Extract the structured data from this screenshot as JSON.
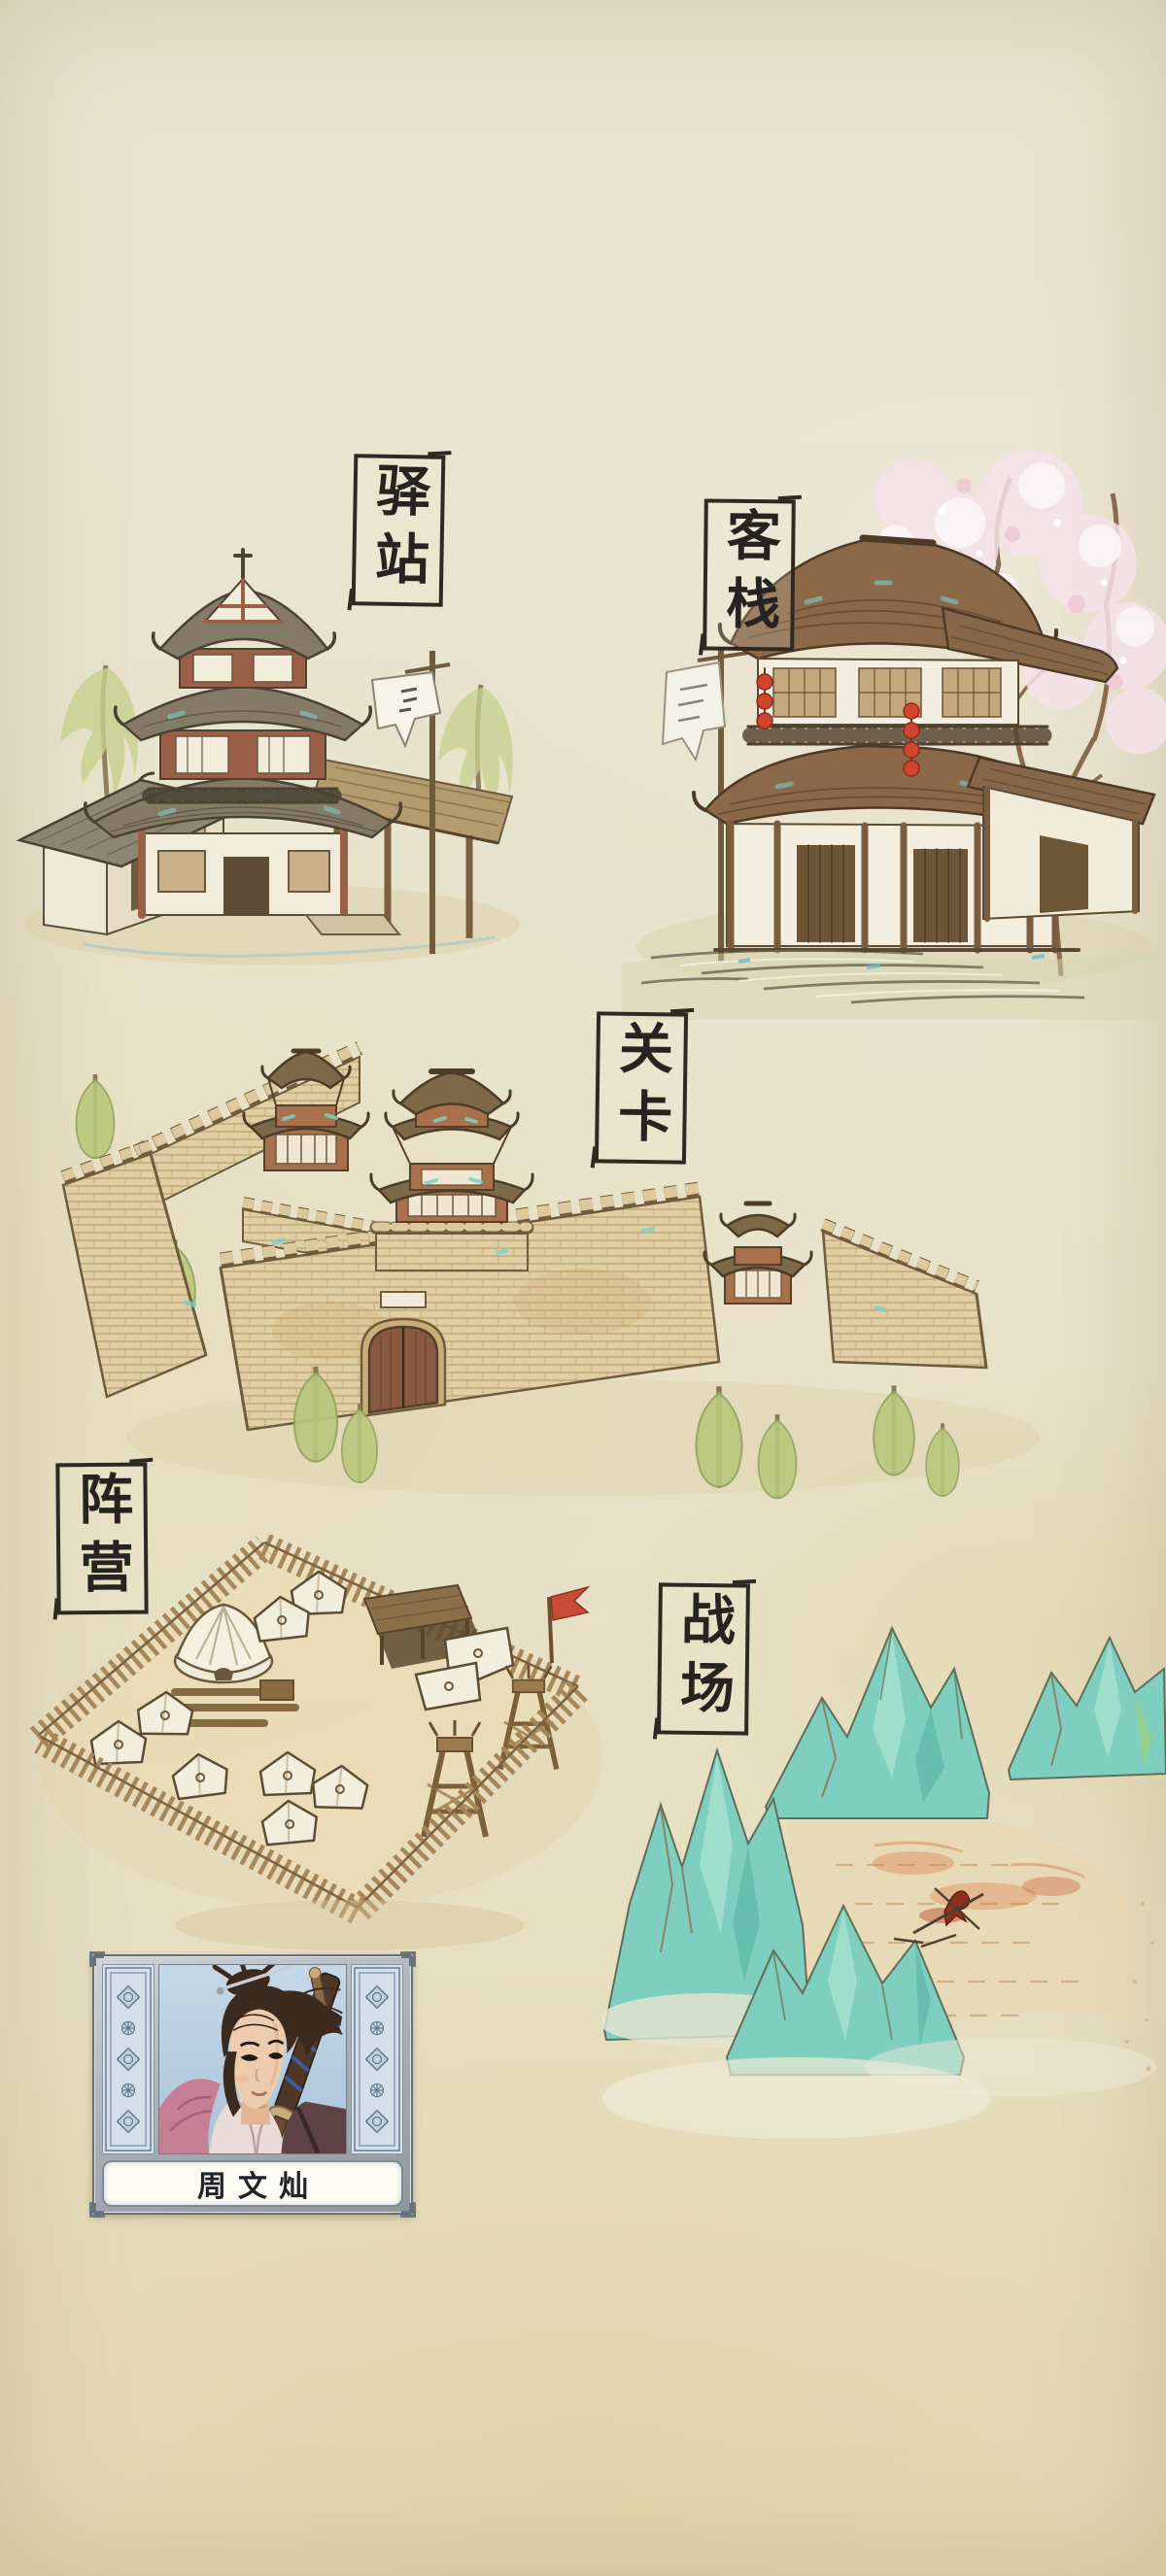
{
  "map": {
    "name": "hand-painted watercolor world map",
    "locations": [
      {
        "id": "post-station",
        "label": "驿站"
      },
      {
        "id": "inn",
        "label": "客栈"
      },
      {
        "id": "checkpoint",
        "label": "关卡"
      },
      {
        "id": "camp",
        "label": "阵营"
      },
      {
        "id": "battlefield",
        "label": "战场"
      }
    ]
  },
  "character": {
    "name": "周文灿"
  },
  "palette": {
    "parchment": "#e8e3cc",
    "ink": "#2e2a23",
    "roof_brown": "#8a6848",
    "roof_gray": "#857a66",
    "wood": "#b2946a",
    "frame_red": "#9a5f47",
    "wall_white": "#f3eee0",
    "brick_tan": "#e0cfa4",
    "teal_accent": "#7fd0c4",
    "mountain_teal": "#7ecfc0",
    "leaf_green": "#bfcc85",
    "lantern_red": "#d0452f",
    "flag_red": "#c84b38",
    "stain_orange": "#d97f4e",
    "card_silver": "#b6bec6",
    "card_panel_blue": "#d4dfea",
    "portrait_blue": "#b7cfe2",
    "robe_pink": "#c67e95"
  }
}
